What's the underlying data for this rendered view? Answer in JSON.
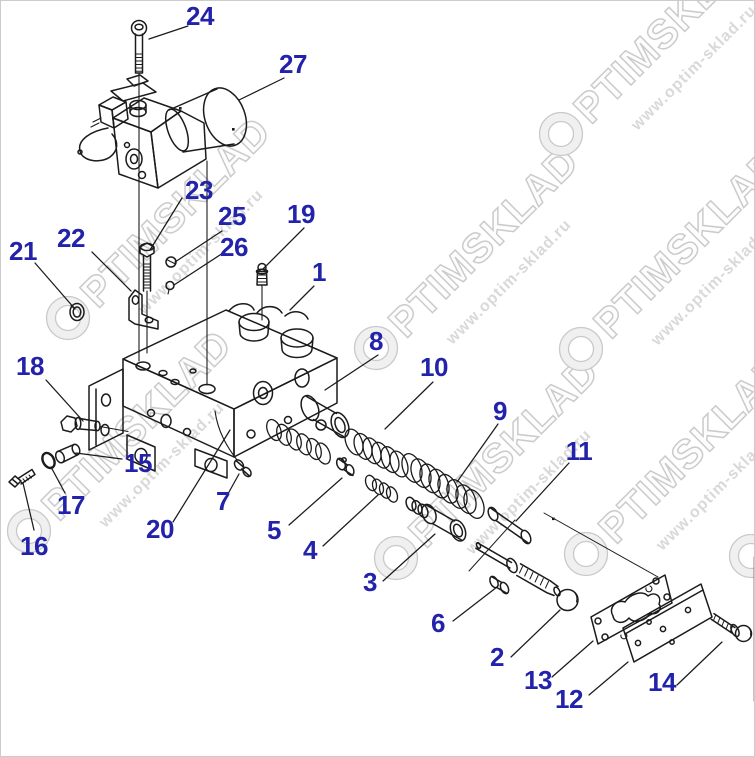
{
  "image": {
    "type": "exploded-parts-diagram",
    "background": "#ffffff",
    "border_color": "#cccccc",
    "line_color": "#1b1b1b"
  },
  "callouts": {
    "color": "#2222aa",
    "items": [
      {
        "label": "1",
        "x": 318,
        "y": 271,
        "leader": [
          313,
          285,
          289,
          309
        ]
      },
      {
        "label": "2",
        "x": 496,
        "y": 656,
        "leader": [
          510,
          656,
          559,
          609
        ]
      },
      {
        "label": "3",
        "x": 369,
        "y": 581,
        "leader": [
          382,
          580,
          434,
          533
        ]
      },
      {
        "label": "4",
        "x": 309,
        "y": 549,
        "leader": [
          322,
          545,
          377,
          494
        ]
      },
      {
        "label": "5",
        "x": 273,
        "y": 529,
        "leader": [
          288,
          524,
          341,
          477
        ]
      },
      {
        "label": "6",
        "x": 437,
        "y": 622,
        "leader": [
          452,
          620,
          496,
          586
        ]
      },
      {
        "label": "7",
        "x": 222,
        "y": 500,
        "leader": [
          228,
          491,
          238,
          473
        ]
      },
      {
        "label": "8",
        "x": 375,
        "y": 340,
        "leader": [
          377,
          354,
          324,
          389
        ]
      },
      {
        "label": "9",
        "x": 499,
        "y": 410,
        "leader": [
          497,
          423,
          456,
          481
        ]
      },
      {
        "label": "10",
        "x": 433,
        "y": 366,
        "leader": [
          432,
          381,
          384,
          428
        ]
      },
      {
        "label": "11",
        "x": 578,
        "y": 450,
        "leader": [
          568,
          462,
          515,
          520
        ]
      },
      {
        "label": "12",
        "x": 568,
        "y": 698,
        "leader": [
          588,
          694,
          627,
          661
        ]
      },
      {
        "label": "13",
        "x": 537,
        "y": 679,
        "leader": [
          551,
          676,
          592,
          640
        ]
      },
      {
        "label": "14",
        "x": 661,
        "y": 681,
        "leader": [
          676,
          684,
          721,
          641
        ]
      },
      {
        "label": "15",
        "x": 137,
        "y": 462,
        "leader": [
          121,
          458,
          75,
          452
        ]
      },
      {
        "label": "16",
        "x": 33,
        "y": 545,
        "leader": [
          33,
          529,
          22,
          482
        ]
      },
      {
        "label": "17",
        "x": 70,
        "y": 504,
        "leader": [
          64,
          492,
          50,
          466
        ]
      },
      {
        "label": "18",
        "x": 29,
        "y": 365,
        "leader": [
          45,
          379,
          82,
          420
        ]
      },
      {
        "label": "19",
        "x": 300,
        "y": 213,
        "leader": [
          303,
          227,
          262,
          268
        ]
      },
      {
        "label": "20",
        "x": 159,
        "y": 528,
        "leader": [
          172,
          521,
          229,
          429
        ]
      },
      {
        "label": "21",
        "x": 22,
        "y": 250,
        "leader": [
          34,
          262,
          74,
          308
        ]
      },
      {
        "label": "22",
        "x": 70,
        "y": 237,
        "leader": [
          91,
          251,
          130,
          290
        ]
      },
      {
        "label": "23",
        "x": 198,
        "y": 189,
        "leader": [
          181,
          197,
          149,
          249
        ]
      },
      {
        "label": "24",
        "x": 199,
        "y": 15,
        "leader": [
          187,
          25,
          148,
          38
        ]
      },
      {
        "label": "25",
        "x": 231,
        "y": 215,
        "leader": [
          221,
          230,
          174,
          261
        ]
      },
      {
        "label": "26",
        "x": 233,
        "y": 246,
        "leader": [
          222,
          252,
          173,
          284
        ]
      },
      {
        "label": "27",
        "x": 292,
        "y": 63,
        "leader": [
          283,
          77,
          238,
          99
        ]
      }
    ]
  },
  "watermark": {
    "brand": "OPTIMSKLAD",
    "letters_after_ring": "PTIMSKLAD",
    "url": "www.optim-sklad.ru",
    "angle": -45,
    "color": "#cbcbcb",
    "instances": [
      {
        "x": 67,
        "y": 317
      },
      {
        "x": 28,
        "y": 530
      },
      {
        "x": 375,
        "y": 347
      },
      {
        "x": 395,
        "y": 557
      },
      {
        "x": 580,
        "y": 348
      },
      {
        "x": 585,
        "y": 553
      },
      {
        "x": 560,
        "y": 133
      },
      {
        "x": 750,
        "y": 555
      }
    ]
  }
}
